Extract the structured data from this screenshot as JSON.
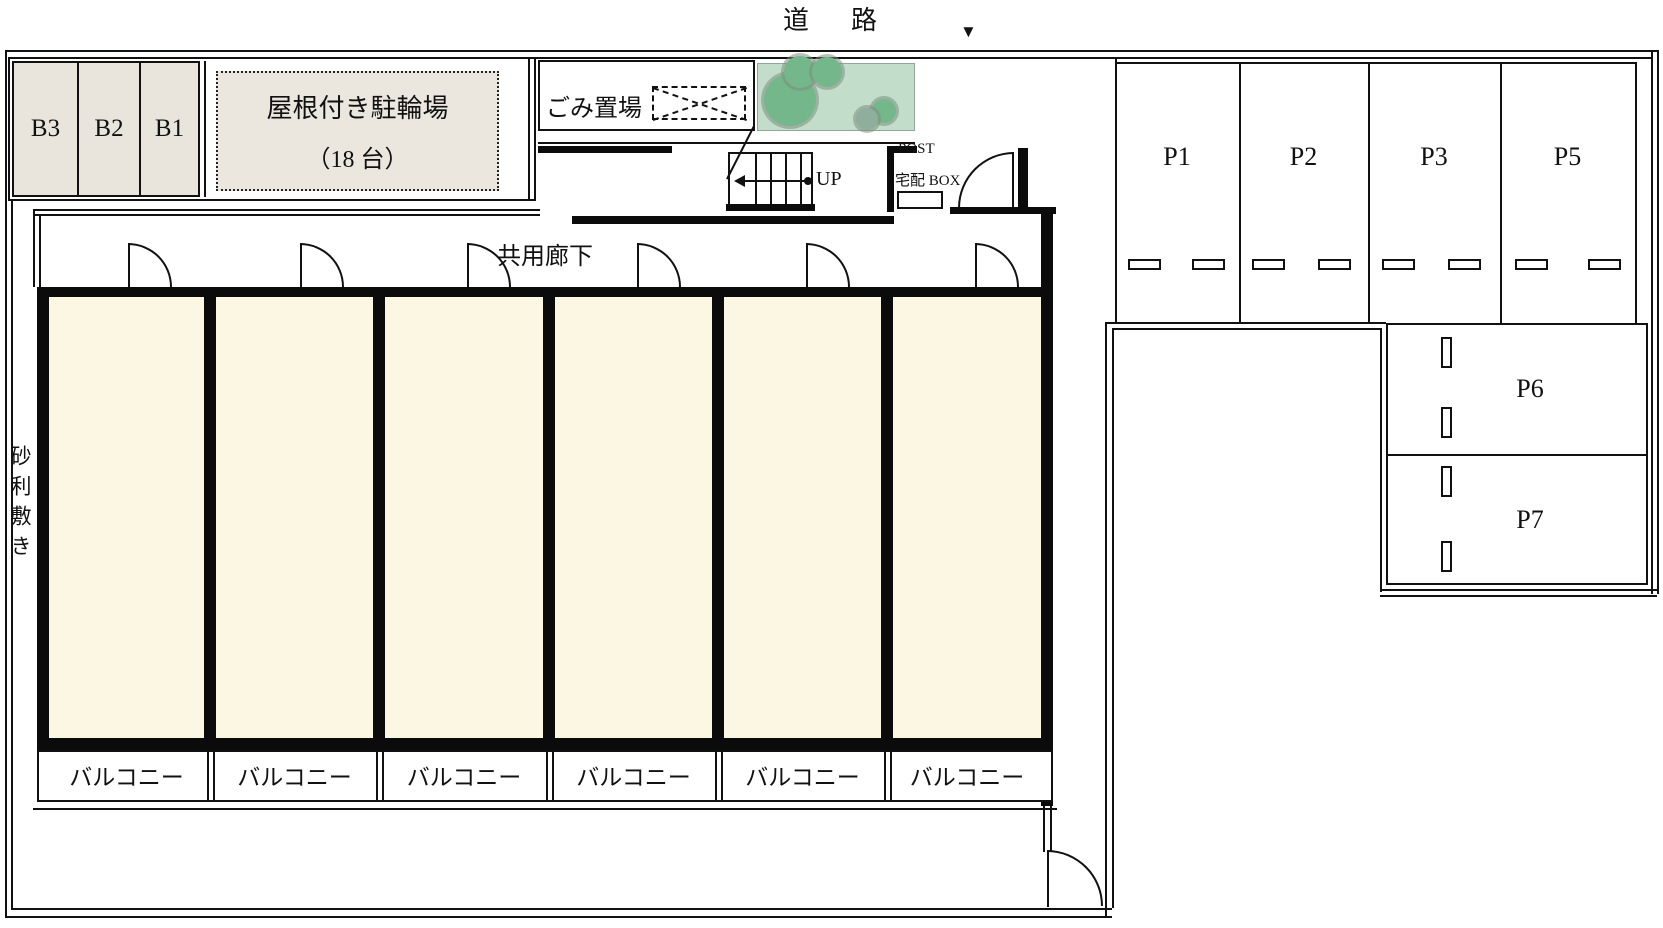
{
  "site": {
    "road_label": "道　路",
    "entrance_arrow": "▼",
    "gravel_label": "砂利敷き"
  },
  "bike_storage": {
    "cells": [
      "B3",
      "B2",
      "B1"
    ],
    "shed_title": "屋根付き駐輪場",
    "shed_capacity": "（18 台）"
  },
  "garbage_label": "ごみ置場",
  "corridor_label": "共用廊下",
  "stairs_label": "UP",
  "mail": {
    "post": "POST",
    "delivery_box": "宅配 BOX"
  },
  "balconies": [
    "バルコニー",
    "バルコニー",
    "バルコニー",
    "バルコニー",
    "バルコニー",
    "バルコニー"
  ],
  "parking": {
    "stalls": [
      {
        "label": "P1"
      },
      {
        "label": "P2"
      },
      {
        "label": "P3"
      },
      {
        "label": "P5"
      }
    ],
    "side_stalls": [
      {
        "label": "P6"
      },
      {
        "label": "P7"
      }
    ]
  },
  "colors": {
    "line": "#111111",
    "room_fill": "#FBF7E2",
    "storage_fill": "#E9E5DC",
    "planting_bg": "#C2DECB",
    "tree": "#74B78A"
  }
}
